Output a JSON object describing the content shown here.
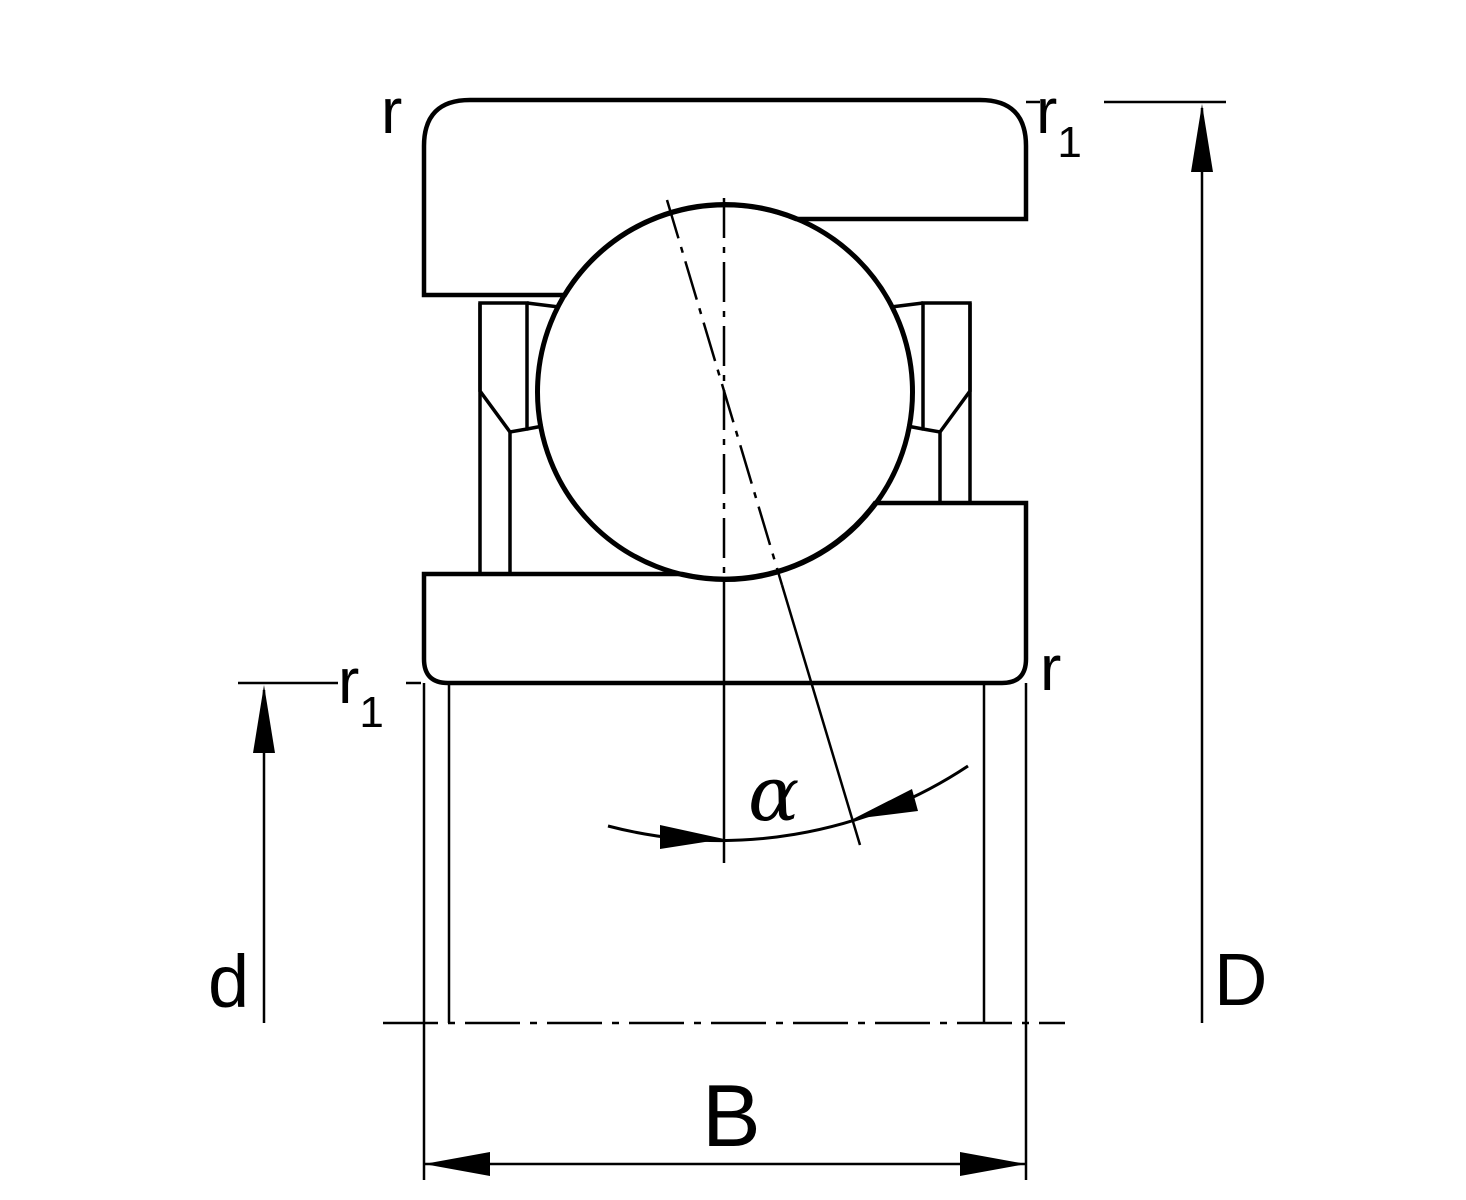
{
  "diagram": {
    "kind": "bearing-cross-section",
    "colors": {
      "ink": "#000000",
      "paper": "#ffffff"
    }
  },
  "labels": {
    "r_top_left": {
      "text": "r"
    },
    "r1_top_right": {
      "base": "r",
      "sub": "1"
    },
    "r1_bottom_left": {
      "base": "r",
      "sub": "1"
    },
    "r_bottom_right": {
      "text": "r"
    },
    "d_bore": {
      "text": "d"
    },
    "D_outside": {
      "text": "D"
    },
    "B_width": {
      "text": "B"
    },
    "alpha_contact_angle": {
      "text": "α"
    }
  }
}
